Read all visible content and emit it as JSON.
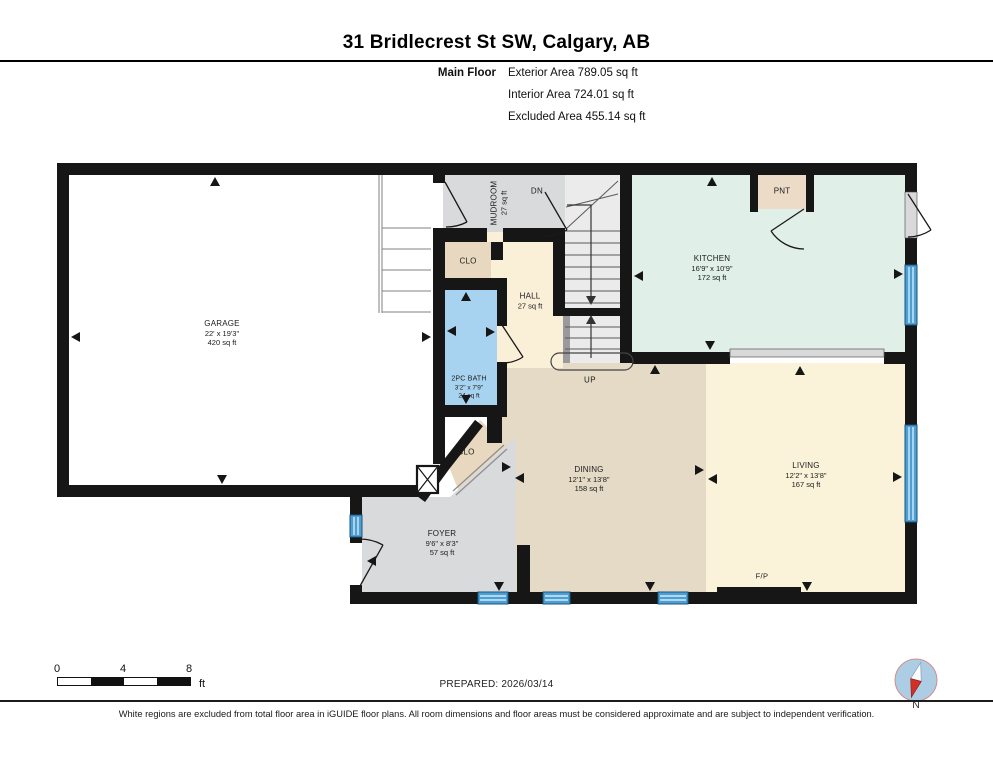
{
  "header": {
    "title": "31 Bridlecrest St SW, Calgary, AB",
    "floor_label": "Main Floor",
    "stats": [
      "Exterior Area 789.05 sq ft",
      "Interior Area 724.01 sq ft",
      "Excluded Area 455.14 sq ft"
    ]
  },
  "rooms": {
    "garage": {
      "name": "GARAGE",
      "dims": "22' x 19'3\"",
      "area": "420 sq ft"
    },
    "kitchen": {
      "name": "KITCHEN",
      "dims": "16'9\" x 10'9\"",
      "area": "172 sq ft"
    },
    "dining": {
      "name": "DINING",
      "dims": "12'1\" x 13'8\"",
      "area": "158 sq ft"
    },
    "living": {
      "name": "LIVING",
      "dims": "12'2\" x 13'8\"",
      "area": "167 sq ft"
    },
    "foyer": {
      "name": "FOYER",
      "dims": "9'6\" x 8'3\"",
      "area": "57 sq ft"
    },
    "bath": {
      "name": "2PC BATH",
      "dims": "3'2\" x 7'9\"",
      "area": "24 sq ft"
    },
    "hall": {
      "name": "HALL",
      "area": "27 sq ft"
    },
    "mudroom": {
      "name": "MUDROOM",
      "area": "27 sq ft"
    },
    "closet_upper": {
      "name": "CLO"
    },
    "closet_lower": {
      "name": "CLO"
    },
    "pantry": {
      "name": "PNT"
    }
  },
  "annotations": {
    "down": "DN",
    "up": "UP",
    "fireplace": "F/P",
    "north": "N"
  },
  "scale_bar": {
    "ticks": [
      "0",
      "4",
      "8"
    ],
    "unit": "ft"
  },
  "footer": {
    "prepared": "PREPARED: 2026/03/14",
    "disclaimer": "White regions are excluded from total floor area in iGUIDE floor plans. All room dimensions and floor areas must be considered approximate and are subject to independent verification."
  },
  "colors": {
    "wall": "#161616",
    "garage": "#ffffff",
    "gray_floor": "#d9dadc",
    "hall": "#faf0d8",
    "kitchen": "#e0efe8",
    "dining": "#e5dac5",
    "living": "#faf3da",
    "bath": "#a8d3f0",
    "closet": "#e9d8c0",
    "pantry": "#ecdcc7",
    "stairs": "#ebebec",
    "door_jamb": "#d9d9db",
    "half_wall": "#d9d9db",
    "window": "#4d9fd3",
    "compass_blue": "#accde4",
    "needle_red": "#d03026"
  }
}
